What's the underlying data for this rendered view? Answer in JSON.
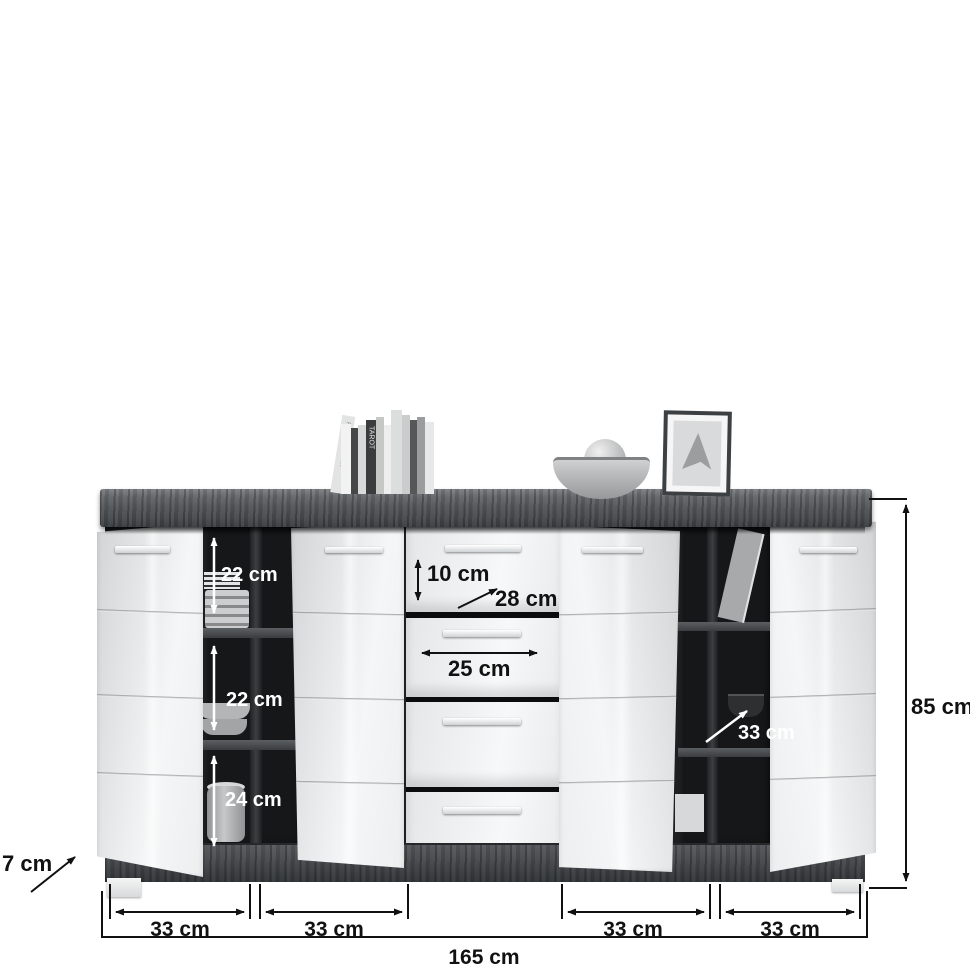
{
  "diagram": {
    "subject": "sideboard with four doors and four drawers, open to show interior",
    "annotation_colors": {
      "dark_line": "#111111",
      "light_line": "#ffffff"
    },
    "furniture_colors": {
      "top_wood": "#54575a",
      "fronts": "#eef0f1",
      "interior": "#151718"
    }
  },
  "dimensions": {
    "left_sections": [
      {
        "label": "22 cm"
      },
      {
        "label": "22 cm"
      },
      {
        "label": "24 cm"
      }
    ],
    "drawer_height": {
      "label": "10 cm"
    },
    "drawer_diagonal": {
      "label": "28 cm"
    },
    "drawer_width": {
      "label": "25 cm"
    },
    "right_depth": {
      "label": "33 cm"
    },
    "total_height": {
      "label": "85 cm"
    },
    "bottom_widths": [
      {
        "label": "33 cm"
      },
      {
        "label": "33 cm"
      },
      {
        "label": "33 cm"
      },
      {
        "label": "33 cm"
      }
    ],
    "total_width": {
      "label": "165 cm"
    },
    "base_height": {
      "label": "7 cm"
    }
  },
  "decor": {
    "book_spines": [
      {
        "text": "PHOTOGRAPHY"
      },
      {
        "text": "TAROT"
      }
    ]
  }
}
